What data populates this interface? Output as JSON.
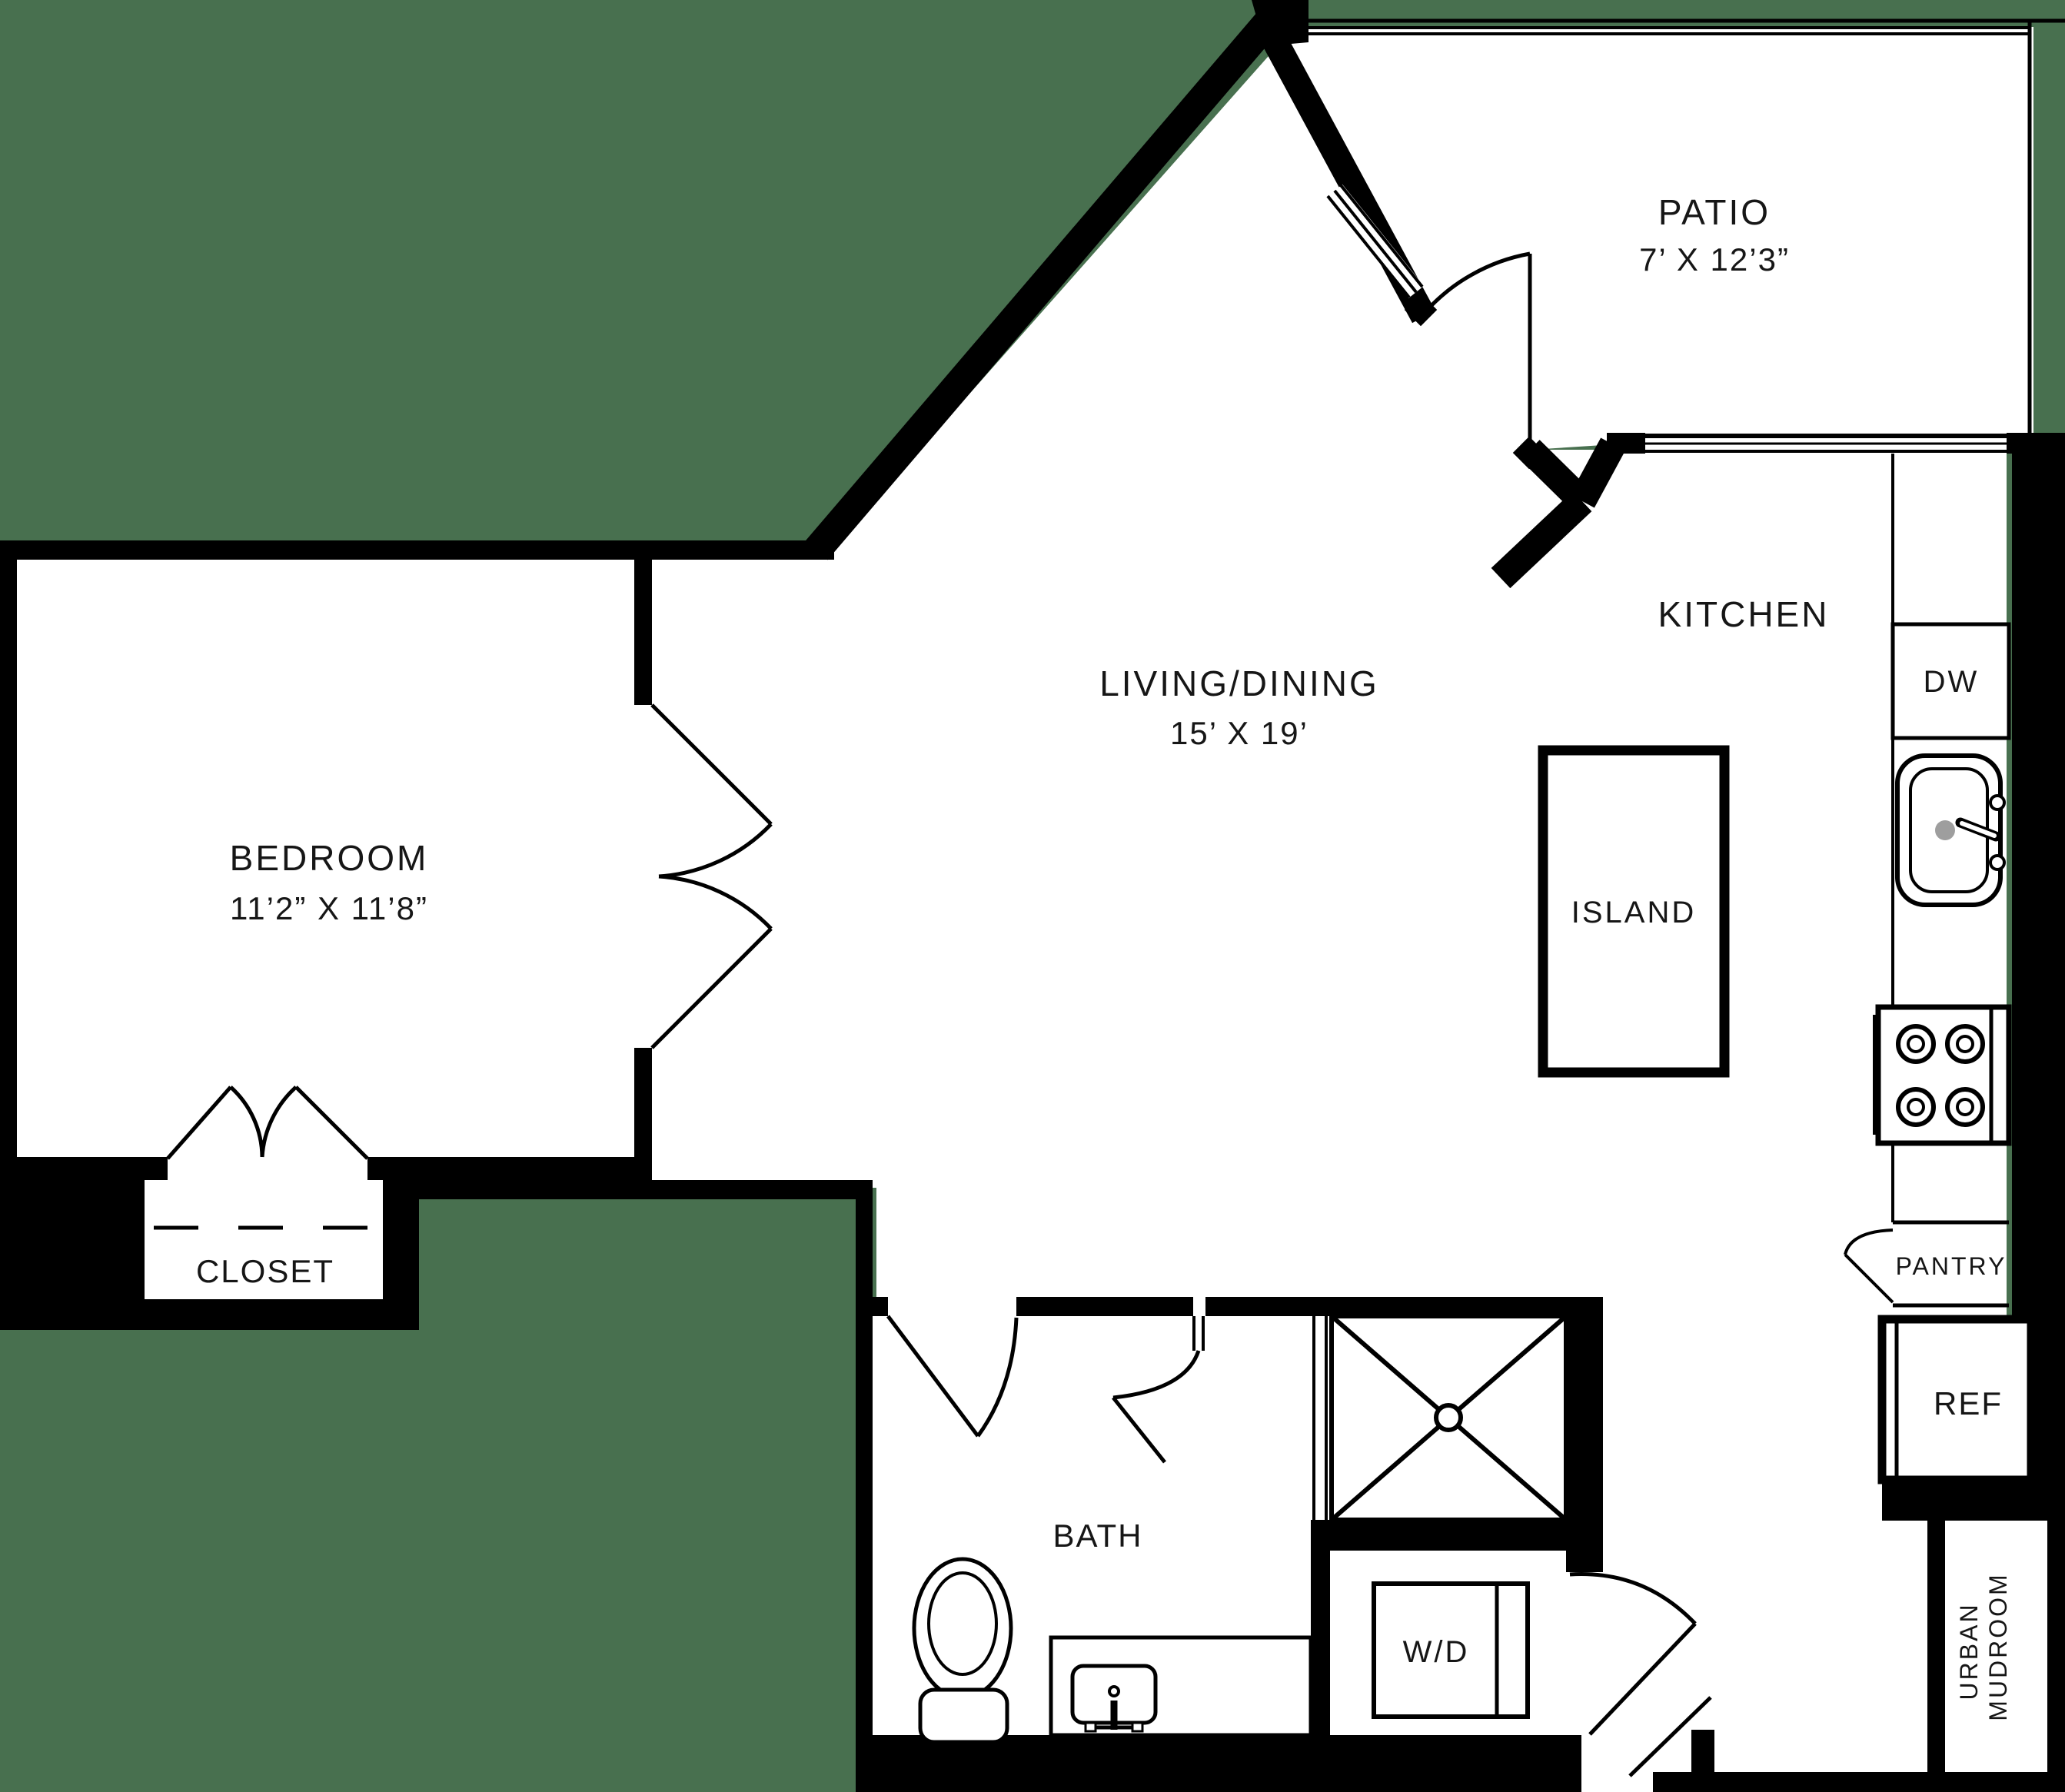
{
  "colors": {
    "background": "#48704F",
    "wall": "#000000",
    "floor": "#ffffff",
    "drain": "#9e9e9e"
  },
  "rooms": {
    "patio": {
      "label": "PATIO",
      "dims": "7’ X 12’3”"
    },
    "kitchen": {
      "label": "KITCHEN"
    },
    "living": {
      "label": "LIVING/DINING",
      "dims": "15’ X 19’"
    },
    "bedroom": {
      "label": "BEDROOM",
      "dims": "11’2” X 11’8”"
    },
    "closet": {
      "label": "CLOSET"
    },
    "bath": {
      "label": "BATH"
    },
    "mudroom": {
      "line1": "URBAN",
      "line2": "MUDROOM"
    }
  },
  "fixtures": {
    "dw": {
      "label": "DW"
    },
    "island": {
      "label": "ISLAND"
    },
    "pantry": {
      "label": "PANTRY"
    },
    "ref": {
      "label": "REF"
    },
    "wd": {
      "label": "W/D"
    }
  }
}
